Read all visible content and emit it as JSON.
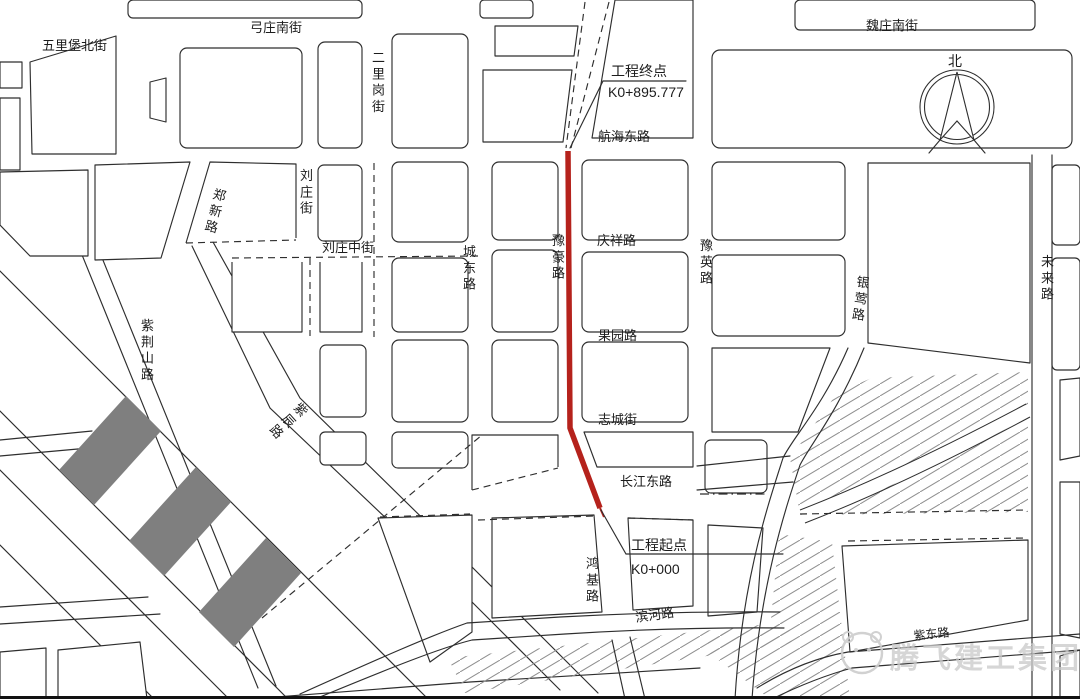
{
  "roads": {
    "wulibao": "五里堡北街",
    "gongzhuang": "弓庄南街",
    "weizhuang": "魏庄南街",
    "erligang": "二里岗街",
    "zhengxin": "郑新路",
    "liuzhuang": "刘庄街",
    "liuzhuangzhong": "刘庄中街",
    "chengdong": "城东路",
    "hanghai": "航海东路",
    "yuhao": "豫豪路",
    "qingxiang": "庆祥路",
    "yuying": "豫英路",
    "guoyuan": "果园路",
    "zhicheng": "志城街",
    "changjiang": "长江东路",
    "yinying": "银莺路",
    "weilai": "未来路",
    "zijingshan": "紫荆山路",
    "zichen": "紫辰路",
    "hongji": "鸿基路",
    "binhe": "滨河路",
    "zidong": "紫东路"
  },
  "annotations": {
    "end_label": "工程终点",
    "end_chainage": "K0+895.777",
    "start_label": "工程起点",
    "start_chainage": "K0+000"
  },
  "compass": {
    "north_label": "北"
  },
  "watermark": {
    "text": "腾飞建工集团"
  },
  "colors": {
    "line": "#2e2e2e",
    "route_red": "#b5221c",
    "block_gray": "#7f7f7f",
    "hatch_gray": "#8f8f8f",
    "watermark_gray": "#c9c9c9"
  }
}
